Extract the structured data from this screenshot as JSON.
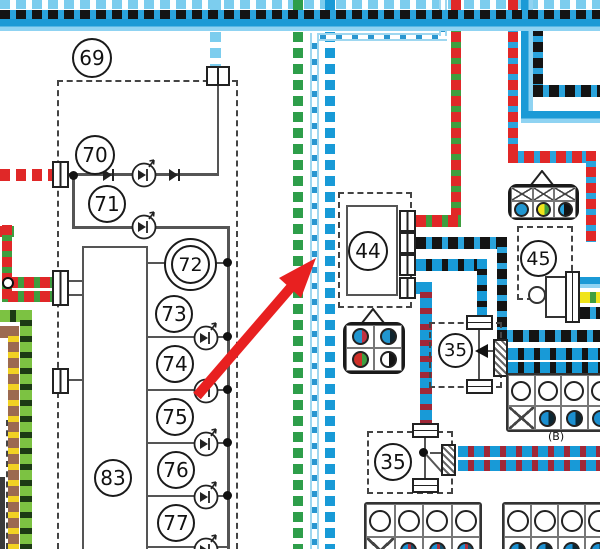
{
  "diagram": {
    "labels": {
      "n69": "69",
      "n70": "70",
      "n71": "71",
      "n72": "72",
      "n73": "73",
      "n74": "74",
      "n75": "75",
      "n76": "76",
      "n77": "77",
      "n83": "83",
      "n44": "44",
      "n45": "45",
      "n35_mid": "35",
      "n35_bottom": "35",
      "connector_b": "(B)"
    },
    "colors": {
      "blue": "#189ad7",
      "light_blue": "#7ccdee",
      "pale_blue": "#9ed7f0",
      "black": "#141414",
      "blue_dash": "#2aa3dc",
      "green": "#2e9e4a",
      "light_green": "#7cc242",
      "red": "#e02828",
      "dark_red": "#a02838",
      "brown": "#9c6a50",
      "yellow": "#f0e41c",
      "white": "#ffffff",
      "arrow_red": "#e82020",
      "line_gray": "#555555"
    },
    "wires": [
      {
        "name": "wire-white-skyblue-top",
        "base": "#7ccdee",
        "dash": "#ffffff",
        "segments": [
          [
            0,
            0,
            600,
            9,
            "h"
          ]
        ]
      },
      {
        "name": "wire-skyblue-drop",
        "base": "#7ccdee",
        "dash": "#ffffff",
        "segments": [
          [
            210,
            0,
            11,
            66,
            "v"
          ]
        ]
      },
      {
        "name": "wire-green-white-vertical",
        "base": "#2e9e4a",
        "dash": "#ffffff",
        "segments": [
          [
            293,
            0,
            10,
            549,
            "v"
          ]
        ]
      },
      {
        "name": "wire-blue-white-vertical",
        "base": "#189ad7",
        "dash": "#ffffff",
        "segments": [
          [
            325,
            0,
            10,
            549,
            "v"
          ]
        ]
      },
      {
        "name": "wire-white-blue",
        "base": "#ffffff",
        "dash": "#2996d0",
        "edge": "#9ed7f0",
        "segments": [
          [
            310,
            33,
            137,
            8,
            "h"
          ],
          [
            439,
            0,
            8,
            36,
            "v"
          ],
          [
            310,
            33,
            9,
            516,
            "v"
          ]
        ]
      },
      {
        "name": "wire-red-green",
        "base": "#e02828",
        "dash": "#3f9e3f",
        "segments": [
          [
            451,
            0,
            10,
            224,
            "v"
          ],
          [
            416,
            215,
            45,
            12,
            "h"
          ],
          [
            0,
            226,
            14,
            11,
            "h"
          ],
          [
            2,
            225,
            10,
            77,
            "v"
          ],
          [
            8,
            277,
            46,
            11,
            "h"
          ],
          [
            8,
            291,
            46,
            11,
            "h"
          ]
        ]
      },
      {
        "name": "wire-red-white",
        "base": "#e02828",
        "dash": "#ffffff",
        "segments": [
          [
            0,
            169,
            53,
            12,
            "h"
          ]
        ]
      },
      {
        "name": "wire-red-blue",
        "base": "#e02828",
        "dash": "#2aa3dc",
        "segments": [
          [
            508,
            0,
            10,
            157,
            "v"
          ],
          [
            508,
            151,
            88,
            12,
            "h"
          ],
          [
            586,
            151,
            10,
            91,
            "v"
          ]
        ]
      },
      {
        "name": "wire-blue-solid",
        "base": "#1b9ad6",
        "tone": "#8fd3f2",
        "segments": [
          [
            521,
            0,
            12,
            119,
            "v"
          ],
          [
            521,
            111,
            79,
            12,
            "h"
          ],
          [
            580,
            277,
            20,
            11,
            "h"
          ]
        ]
      },
      {
        "name": "wire-black-blue",
        "base": "#141414",
        "dash": "#2aa3dc",
        "segments": [
          [
            533,
            10,
            10,
            83,
            "v"
          ],
          [
            533,
            85,
            67,
            12,
            "h"
          ],
          [
            416,
            237,
            91,
            12,
            "h"
          ],
          [
            497,
            237,
            10,
            103,
            "v"
          ],
          [
            497,
            330,
            103,
            12,
            "h"
          ],
          [
            580,
            307,
            20,
            12,
            "h"
          ]
        ]
      },
      {
        "name": "wire-blue-black",
        "base": "#189ad7",
        "dash": "#141414",
        "segments": [
          [
            416,
            259,
            71,
            12,
            "h"
          ],
          [
            477,
            259,
            10,
            59,
            "v"
          ],
          [
            508,
            348,
            92,
            12,
            "h"
          ],
          [
            508,
            362,
            92,
            12,
            "h"
          ]
        ]
      },
      {
        "name": "wire-blue-red",
        "base": "#189ad7",
        "dash": "#a02838",
        "segments": [
          [
            416,
            282,
            16,
            12,
            "h"
          ],
          [
            420,
            282,
            12,
            145,
            "v"
          ],
          [
            458,
            446,
            142,
            11,
            "h"
          ],
          [
            458,
            460,
            142,
            11,
            "h"
          ]
        ]
      },
      {
        "name": "wire-green-black",
        "base": "#7cc242",
        "dash": "#1c3a14",
        "segments": [
          [
            0,
            310,
            32,
            12,
            "h"
          ],
          [
            20,
            310,
            12,
            239,
            "v"
          ]
        ]
      },
      {
        "name": "wire-brown-yellow",
        "base": "#9c6a50",
        "dash": "#f2d223",
        "segments": [
          [
            0,
            326,
            19,
            12,
            "h"
          ],
          [
            8,
            326,
            11,
            223,
            "v"
          ]
        ]
      },
      {
        "name": "wire-yellow-green",
        "base": "#f0e41c",
        "dash": "#3f9e3f",
        "segments": [
          [
            580,
            292,
            20,
            11,
            "h"
          ]
        ]
      },
      {
        "name": "wire-black-blue-top",
        "base": "#141414",
        "dash": "#2aa3dc",
        "segments": [
          [
            0,
            10,
            600,
            9,
            "h"
          ]
        ]
      },
      {
        "name": "wire-blue-top",
        "base": "#1b9ad6",
        "tone": "#8fd3f2",
        "segments": [
          [
            0,
            19,
            600,
            12,
            "h"
          ]
        ]
      }
    ],
    "graphics": {
      "lines": [
        [
          217,
          84,
          2,
          92
        ],
        [
          68,
          173,
          150,
          3
        ],
        [
          72,
          176,
          3,
          52
        ],
        [
          72,
          226,
          156,
          3
        ],
        [
          227,
          226,
          3,
          323
        ],
        [
          148,
          262,
          80,
          2
        ],
        [
          148,
          336,
          80,
          2
        ],
        [
          148,
          389,
          80,
          2
        ],
        [
          148,
          442,
          80,
          2
        ],
        [
          148,
          495,
          80,
          2
        ],
        [
          148,
          546,
          80,
          2
        ],
        [
          68,
          280,
          16,
          2
        ],
        [
          68,
          294,
          16,
          2
        ],
        [
          68,
          379,
          16,
          2
        ],
        [
          478,
          330,
          2,
          50
        ],
        [
          487,
          350,
          8,
          2
        ],
        [
          424,
          438,
          2,
          41
        ],
        [
          430,
          452,
          13,
          2
        ]
      ],
      "dots": [
        [
          69,
          171
        ],
        [
          223,
          258
        ],
        [
          223,
          332
        ],
        [
          223,
          385
        ],
        [
          223,
          438
        ],
        [
          223,
          491
        ],
        [
          419,
          448
        ]
      ],
      "open_junction": [
        2,
        277
      ],
      "leds": [
        [
          130,
          158
        ],
        [
          130,
          210
        ],
        [
          192,
          321
        ],
        [
          192,
          374
        ],
        [
          192,
          427
        ],
        [
          192,
          480
        ],
        [
          192,
          533
        ]
      ],
      "diodes": [
        [
          100,
          167
        ],
        [
          166,
          167
        ]
      ]
    }
  }
}
